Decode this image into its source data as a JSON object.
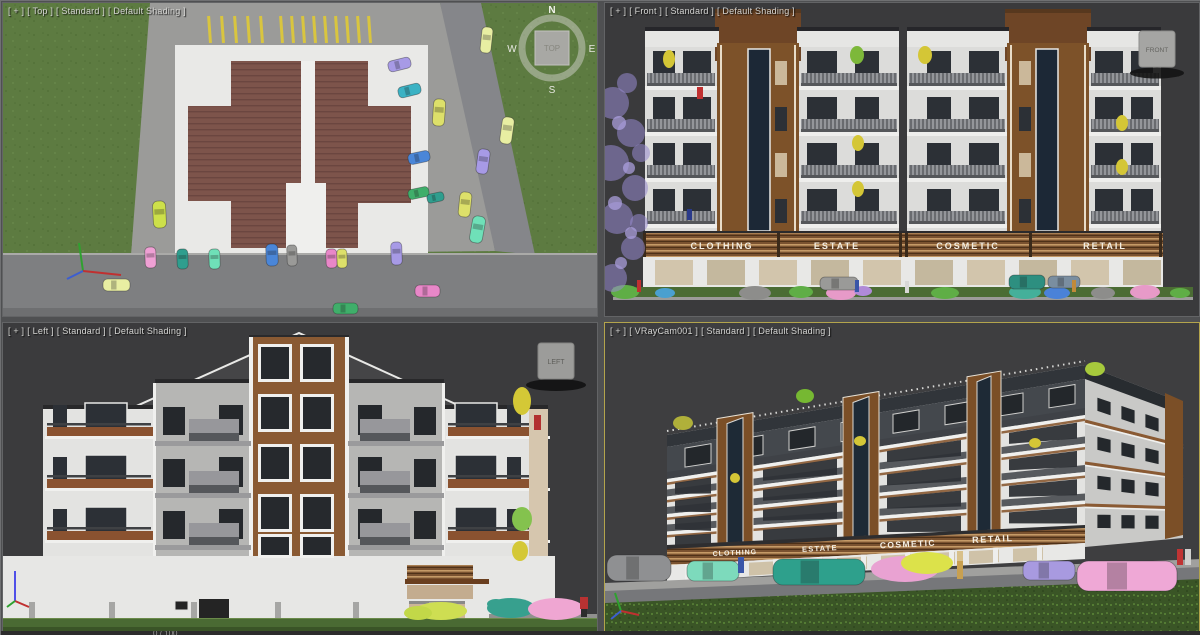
{
  "viewports": {
    "top": {
      "menu": {
        "general": "[ + ]",
        "pov": "[ Top ]",
        "standard": "[ Standard ]",
        "shading": "[ Default Shading ]"
      }
    },
    "front": {
      "menu": {
        "general": "[ + ]",
        "pov": "[ Front ]",
        "standard": "[ Standard ]",
        "shading": "[ Default Shading ]"
      }
    },
    "left": {
      "menu": {
        "general": "[ + ]",
        "pov": "[ Left ]",
        "standard": "[ Standard ]",
        "shading": "[ Default Shading ]"
      }
    },
    "camera": {
      "menu": {
        "general": "[ + ]",
        "pov": "[ VRayCam001 ]",
        "standard": "[ Standard ]",
        "shading": "[ Default Shading ]"
      }
    }
  },
  "viewcube": {
    "top": {
      "face": "TOP",
      "north": "N",
      "south": "S",
      "east": "E",
      "west": "W"
    },
    "front": {
      "face": "FRONT"
    },
    "left": {
      "face": "LEFT"
    }
  },
  "shop_signs": [
    "CLOTHING",
    "ESTATE",
    "COSMETIC",
    "RETAIL"
  ],
  "timeline": {
    "frame": "0 / 100"
  },
  "colors": {
    "active_viewport_border": "#b3a44c",
    "grass_top_view": "#5d7b41",
    "roof_brown": "#7d544b",
    "facade_brown": "#8a5a33",
    "window_dark": "#2c3036",
    "glass_navy": "#1c2836"
  },
  "palette": {
    "car_colors": {
      "yellow": "#dde06a",
      "pale_yellow": "#e8eea2",
      "green": "#3fae6a",
      "mint": "#6fe0b8",
      "teal": "#2f9e8e",
      "cyan": "#3bb2c4",
      "blue": "#4a86d8",
      "purple": "#a79ae6",
      "pink": "#efa0d4",
      "magenta": "#e887c8",
      "gray": "#9a9a98",
      "lime": "#cde04a"
    }
  }
}
